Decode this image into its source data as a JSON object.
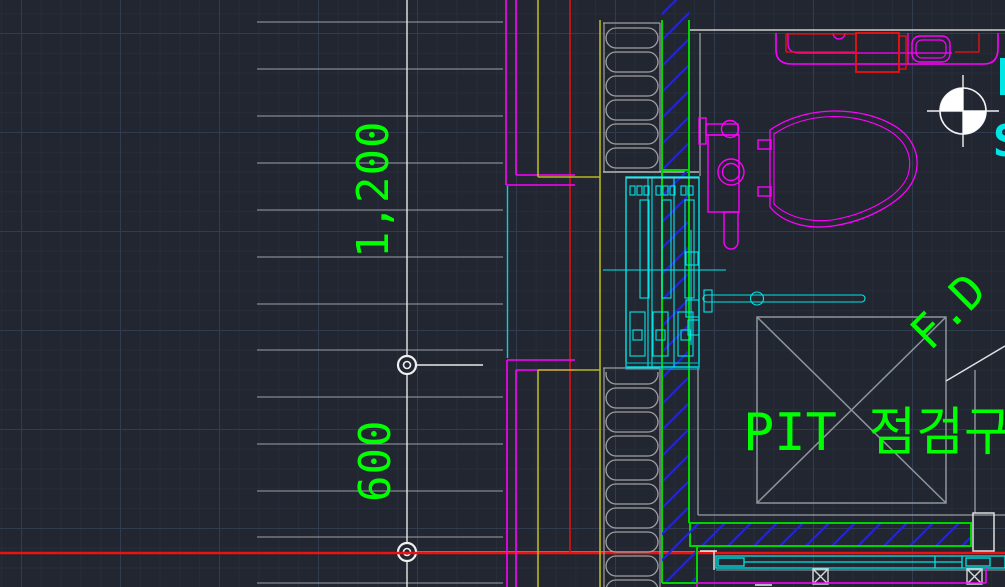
{
  "app": {
    "name": "CAD drawing viewport",
    "view": "bathroom wall section / PIT detail plan"
  },
  "colors": {
    "background": "#212631",
    "grid_minor": "#262d3a",
    "grid_major": "#323c4f",
    "annotation_green": "#00ff00",
    "band_green": "#00d400",
    "magenta": "#ff00ff",
    "cyan": "#00ffff",
    "red": "#ff0000",
    "yellow": "#b8b81e",
    "hatch_blue": "#2424dd",
    "line_gray": "#9aa0a6",
    "line_white": "#e8e8e8"
  },
  "annotations": {
    "dim_1200": "1,200",
    "dim_600": "600",
    "pit_label": "PIT 점검구",
    "fd_label": "F.D",
    "edge_label_fragment": "S"
  },
  "drawing": {
    "dimension_markers": [
      {
        "x": 407,
        "y": 365
      },
      {
        "x": 407,
        "y": 552
      }
    ],
    "symbols": [
      "datum-point",
      "pit-access-hatch",
      "inspection-box-crossed",
      "insulation-batt",
      "blue-wall-hatch",
      "toilet-plan",
      "vanity-counter-plan",
      "window-frame-section",
      "fd-leader-line"
    ]
  }
}
